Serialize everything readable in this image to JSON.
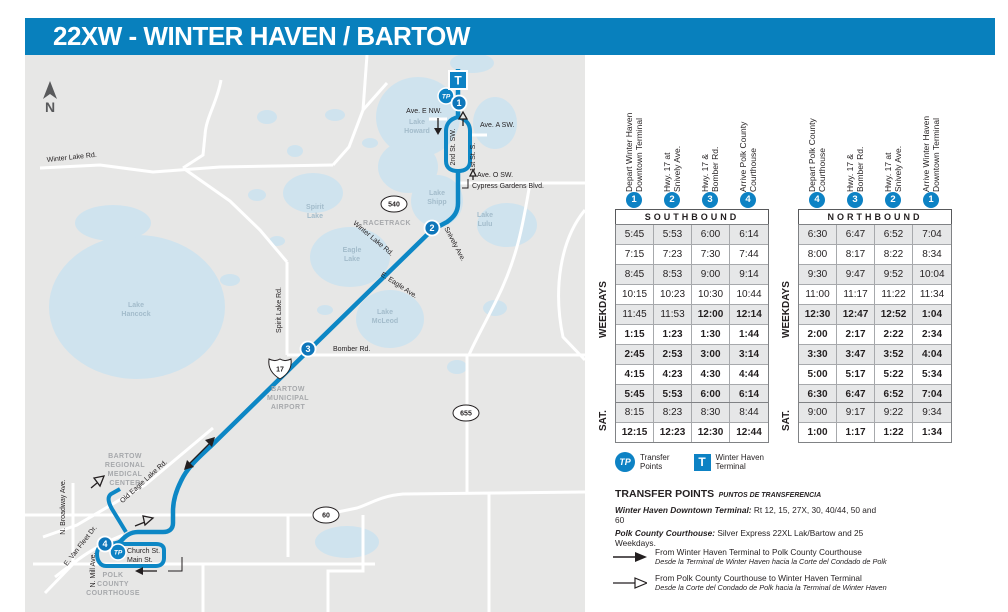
{
  "title": "22XW - WINTER HAVEN / BARTOW",
  "colors": {
    "brand_blue": "#0880bd",
    "route_blue": "#0d87c5",
    "marker_blue": "#0d82c4",
    "map_background": "#e7e7e6",
    "lake_blue": "#cfe3ee",
    "row_stripe": "#e6e7e8"
  },
  "map": {
    "compass": "N",
    "terminal": {
      "icon": "T",
      "x": 433,
      "y": 25
    },
    "transfer_icon": "TP",
    "transfer_markers": [
      {
        "x": 421,
        "y": 41
      },
      {
        "x": 93,
        "y": 497
      }
    ],
    "stops": [
      {
        "num": "1",
        "x": 434,
        "y": 48
      },
      {
        "num": "2",
        "x": 407,
        "y": 173
      },
      {
        "num": "3",
        "x": 283,
        "y": 294
      },
      {
        "num": "4",
        "x": 80,
        "y": 489
      }
    ],
    "shields": [
      {
        "label": "540",
        "x": 369,
        "y": 149,
        "shape": "oval"
      },
      {
        "label": "17",
        "x": 255,
        "y": 314,
        "shape": "us"
      },
      {
        "label": "655",
        "x": 441,
        "y": 358,
        "shape": "oval"
      },
      {
        "label": "60",
        "x": 301,
        "y": 460,
        "shape": "oval"
      }
    ],
    "street_labels": [
      {
        "text": "Ave. E NW.",
        "x": 399,
        "y": 58,
        "rot": 0,
        "anchor": "middle"
      },
      {
        "text": "Ave. A SW.",
        "x": 455,
        "y": 72,
        "rot": 0,
        "anchor": "start"
      },
      {
        "text": "Ave. O SW.",
        "x": 452,
        "y": 122,
        "rot": 0,
        "anchor": "start"
      },
      {
        "text": "Cypress Gardens Blvd.",
        "x": 447,
        "y": 133,
        "rot": 0,
        "anchor": "start"
      },
      {
        "text": "2nd St. SW.",
        "x": 430,
        "y": 92,
        "rot": -90,
        "anchor": "middle"
      },
      {
        "text": "1st St. S.",
        "x": 450,
        "y": 102,
        "rot": -90,
        "anchor": "middle"
      },
      {
        "text": "Winter Lake Rd.",
        "x": 22,
        "y": 107,
        "rot": -6,
        "anchor": "start"
      },
      {
        "text": "Winter Lake Rd.",
        "x": 347,
        "y": 185,
        "rot": 40,
        "anchor": "middle"
      },
      {
        "text": "Snively Ave.",
        "x": 428,
        "y": 190,
        "rot": 62,
        "anchor": "middle"
      },
      {
        "text": "E. Eagle Ave.",
        "x": 373,
        "y": 232,
        "rot": 33,
        "anchor": "middle"
      },
      {
        "text": "Spirit Lake Rd.",
        "x": 256,
        "y": 255,
        "rot": -90,
        "anchor": "middle"
      },
      {
        "text": "Bomber Rd.",
        "x": 308,
        "y": 296,
        "rot": 0,
        "anchor": "start"
      },
      {
        "text": "Old Eagle Lake Rd.",
        "x": 120,
        "y": 428,
        "rot": -42,
        "anchor": "middle"
      },
      {
        "text": "N. Broadway Ave.",
        "x": 40,
        "y": 452,
        "rot": -90,
        "anchor": "middle"
      },
      {
        "text": "E. Van Fleet Dr.",
        "x": 57,
        "y": 492,
        "rot": -52,
        "anchor": "middle"
      },
      {
        "text": "N. Mill Ave.",
        "x": 70,
        "y": 515,
        "rot": -90,
        "anchor": "middle"
      },
      {
        "text": "Church St.",
        "x": 102,
        "y": 498,
        "rot": 0,
        "anchor": "start"
      },
      {
        "text": "Main St.",
        "x": 102,
        "y": 507,
        "rot": 0,
        "anchor": "start"
      }
    ],
    "place_labels": [
      {
        "lines": [
          "RACETRACK"
        ],
        "x": 362,
        "y": 170
      },
      {
        "lines": [
          "BARTOW",
          "MUNICIPAL",
          "AIRPORT"
        ],
        "x": 263,
        "y": 336
      },
      {
        "lines": [
          "BARTOW",
          "REGIONAL",
          "MEDICAL",
          "CENTER"
        ],
        "x": 100,
        "y": 403
      },
      {
        "lines": [
          "POLK",
          "COUNTY",
          "COURTHOUSE"
        ],
        "x": 88,
        "y": 522
      }
    ],
    "lake_labels": [
      {
        "lines": [
          "Lake",
          "Howard"
        ],
        "x": 392,
        "y": 69
      },
      {
        "lines": [
          "Lake",
          "Shipp"
        ],
        "x": 412,
        "y": 140
      },
      {
        "lines": [
          "Lake",
          "Lulu"
        ],
        "x": 460,
        "y": 162
      },
      {
        "lines": [
          "Spirit",
          "Lake"
        ],
        "x": 290,
        "y": 154
      },
      {
        "lines": [
          "Eagle",
          "Lake"
        ],
        "x": 327,
        "y": 197
      },
      {
        "lines": [
          "Lake",
          "McLeod"
        ],
        "x": 360,
        "y": 259
      },
      {
        "lines": [
          "Lake",
          "Hancock"
        ],
        "x": 111,
        "y": 252
      }
    ]
  },
  "schedules": [
    {
      "direction": "SOUTHBOUND",
      "day_label": "WEEKDAYS",
      "sat_label": "SAT.",
      "columns": [
        {
          "num": "1",
          "lines": [
            "Depart Winter Haven",
            "Downtown Terminal"
          ]
        },
        {
          "num": "2",
          "lines": [
            "Hwy. 17 at",
            "Snively Ave."
          ]
        },
        {
          "num": "3",
          "lines": [
            "Hwy. 17 &",
            "Bomber Rd."
          ]
        },
        {
          "num": "4",
          "lines": [
            "Arrive Polk County",
            "Courthouse"
          ]
        }
      ],
      "weekday_rows": [
        [
          {
            "t": "5:45",
            "pm": false
          },
          {
            "t": "5:53",
            "pm": false
          },
          {
            "t": "6:00",
            "pm": false
          },
          {
            "t": "6:14",
            "pm": false
          }
        ],
        [
          {
            "t": "7:15",
            "pm": false
          },
          {
            "t": "7:23",
            "pm": false
          },
          {
            "t": "7:30",
            "pm": false
          },
          {
            "t": "7:44",
            "pm": false
          }
        ],
        [
          {
            "t": "8:45",
            "pm": false
          },
          {
            "t": "8:53",
            "pm": false
          },
          {
            "t": "9:00",
            "pm": false
          },
          {
            "t": "9:14",
            "pm": false
          }
        ],
        [
          {
            "t": "10:15",
            "pm": false
          },
          {
            "t": "10:23",
            "pm": false
          },
          {
            "t": "10:30",
            "pm": false
          },
          {
            "t": "10:44",
            "pm": false
          }
        ],
        [
          {
            "t": "11:45",
            "pm": false
          },
          {
            "t": "11:53",
            "pm": false
          },
          {
            "t": "12:00",
            "pm": true
          },
          {
            "t": "12:14",
            "pm": true
          }
        ],
        [
          {
            "t": "1:15",
            "pm": true
          },
          {
            "t": "1:23",
            "pm": true
          },
          {
            "t": "1:30",
            "pm": true
          },
          {
            "t": "1:44",
            "pm": true
          }
        ],
        [
          {
            "t": "2:45",
            "pm": true
          },
          {
            "t": "2:53",
            "pm": true
          },
          {
            "t": "3:00",
            "pm": true
          },
          {
            "t": "3:14",
            "pm": true
          }
        ],
        [
          {
            "t": "4:15",
            "pm": true
          },
          {
            "t": "4:23",
            "pm": true
          },
          {
            "t": "4:30",
            "pm": true
          },
          {
            "t": "4:44",
            "pm": true
          }
        ],
        [
          {
            "t": "5:45",
            "pm": true
          },
          {
            "t": "5:53",
            "pm": true
          },
          {
            "t": "6:00",
            "pm": true
          },
          {
            "t": "6:14",
            "pm": true
          }
        ]
      ],
      "sat_rows": [
        [
          {
            "t": "8:15",
            "pm": false
          },
          {
            "t": "8:23",
            "pm": false
          },
          {
            "t": "8:30",
            "pm": false
          },
          {
            "t": "8:44",
            "pm": false
          }
        ],
        [
          {
            "t": "12:15",
            "pm": true
          },
          {
            "t": "12:23",
            "pm": true
          },
          {
            "t": "12:30",
            "pm": true
          },
          {
            "t": "12:44",
            "pm": true
          }
        ]
      ]
    },
    {
      "direction": "NORTHBOUND",
      "day_label": "WEEKDAYS",
      "sat_label": "SAT.",
      "columns": [
        {
          "num": "4",
          "lines": [
            "Depart Polk County",
            "Courthouse"
          ]
        },
        {
          "num": "3",
          "lines": [
            "Hwy. 17 &",
            "Bomber Rd."
          ]
        },
        {
          "num": "2",
          "lines": [
            "Hwy. 17 at",
            "Snively Ave."
          ]
        },
        {
          "num": "1",
          "lines": [
            "Arrive Winter Haven",
            "Downtown Terminal"
          ]
        }
      ],
      "weekday_rows": [
        [
          {
            "t": "6:30",
            "pm": false
          },
          {
            "t": "6:47",
            "pm": false
          },
          {
            "t": "6:52",
            "pm": false
          },
          {
            "t": "7:04",
            "pm": false
          }
        ],
        [
          {
            "t": "8:00",
            "pm": false
          },
          {
            "t": "8:17",
            "pm": false
          },
          {
            "t": "8:22",
            "pm": false
          },
          {
            "t": "8:34",
            "pm": false
          }
        ],
        [
          {
            "t": "9:30",
            "pm": false
          },
          {
            "t": "9:47",
            "pm": false
          },
          {
            "t": "9:52",
            "pm": false
          },
          {
            "t": "10:04",
            "pm": false
          }
        ],
        [
          {
            "t": "11:00",
            "pm": false
          },
          {
            "t": "11:17",
            "pm": false
          },
          {
            "t": "11:22",
            "pm": false
          },
          {
            "t": "11:34",
            "pm": false
          }
        ],
        [
          {
            "t": "12:30",
            "pm": true
          },
          {
            "t": "12:47",
            "pm": true
          },
          {
            "t": "12:52",
            "pm": true
          },
          {
            "t": "1:04",
            "pm": true
          }
        ],
        [
          {
            "t": "2:00",
            "pm": true
          },
          {
            "t": "2:17",
            "pm": true
          },
          {
            "t": "2:22",
            "pm": true
          },
          {
            "t": "2:34",
            "pm": true
          }
        ],
        [
          {
            "t": "3:30",
            "pm": true
          },
          {
            "t": "3:47",
            "pm": true
          },
          {
            "t": "3:52",
            "pm": true
          },
          {
            "t": "4:04",
            "pm": true
          }
        ],
        [
          {
            "t": "5:00",
            "pm": true
          },
          {
            "t": "5:17",
            "pm": true
          },
          {
            "t": "5:22",
            "pm": true
          },
          {
            "t": "5:34",
            "pm": true
          }
        ],
        [
          {
            "t": "6:30",
            "pm": true
          },
          {
            "t": "6:47",
            "pm": true
          },
          {
            "t": "6:52",
            "pm": true
          },
          {
            "t": "7:04",
            "pm": true
          }
        ]
      ],
      "sat_rows": [
        [
          {
            "t": "9:00",
            "pm": false
          },
          {
            "t": "9:17",
            "pm": false
          },
          {
            "t": "9:22",
            "pm": false
          },
          {
            "t": "9:34",
            "pm": false
          }
        ],
        [
          {
            "t": "1:00",
            "pm": true
          },
          {
            "t": "1:17",
            "pm": true
          },
          {
            "t": "1:22",
            "pm": true
          },
          {
            "t": "1:34",
            "pm": true
          }
        ]
      ]
    }
  ],
  "legend": {
    "transfer": {
      "icon": "TP",
      "label": "Transfer\nPoints"
    },
    "terminal": {
      "icon": "T",
      "label": "Winter Haven\nTerminal"
    }
  },
  "transfer_points": {
    "heading": "TRANSFER POINTS",
    "heading_es": "PUNTOS DE TRANSFERENCIA",
    "entries": [
      {
        "name": "Winter Haven Downtown Terminal:",
        "detail": " Rt 12, 15, 27X, 30, 40/44, 50 and 60"
      },
      {
        "name": "Polk County Courthouse:",
        "detail": " Silver Express 22XL Lak/Bartow and 25 Weekdays."
      }
    ]
  },
  "direction_arrows": [
    {
      "style": "solid",
      "en": "From Winter Haven Terminal to Polk County Courthouse",
      "es": "Desde la Terminal de Winter Haven hacia la Corte del Condado de Polk"
    },
    {
      "style": "hollow",
      "en": "From Polk County Courthouse to Winter Haven Terminal",
      "es": "Desde la Corte del Condado de Polk hacia la Terminal de Winter Haven"
    }
  ]
}
